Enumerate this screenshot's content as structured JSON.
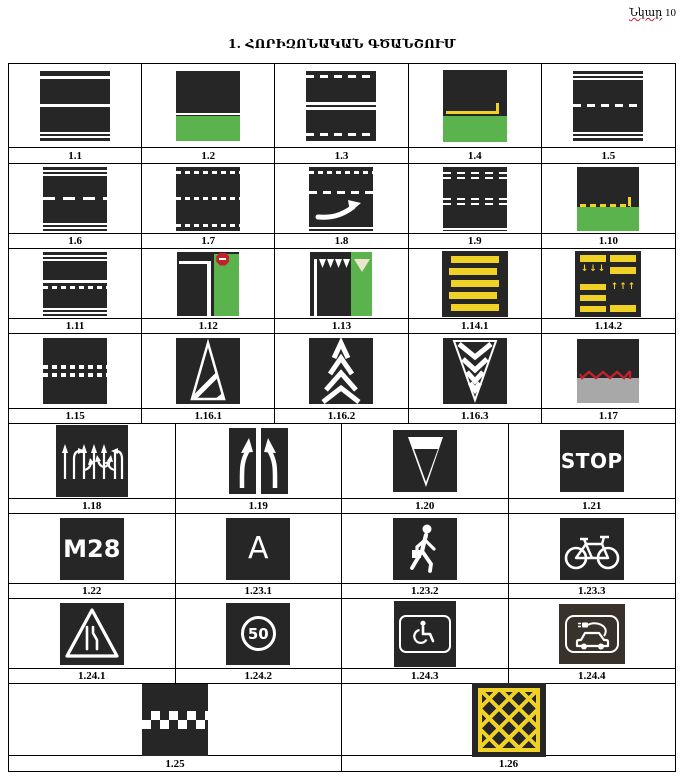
{
  "header": {
    "figure_word": "Նկար",
    "figure_number": "10",
    "title": "1. ՀՈՐԻԶՈՆԱԿԱՆ ԳԾԱՆՇՈՒՄ"
  },
  "labels": {
    "l1_1": "1.1",
    "l1_2": "1.2",
    "l1_3": "1.3",
    "l1_4": "1.4",
    "l1_5": "1.5",
    "l1_6": "1.6",
    "l1_7": "1.7",
    "l1_8": "1.8",
    "l1_9": "1.9",
    "l1_10": "1.10",
    "l1_11": "1.11",
    "l1_12": "1.12",
    "l1_13": "1.13",
    "l1_14_1": "1.14.1",
    "l1_14_2": "1.14.2",
    "l1_15": "1.15",
    "l1_16_1": "1.16.1",
    "l1_16_2": "1.16.2",
    "l1_16_3": "1.16.3",
    "l1_17": "1.17",
    "l1_18": "1.18",
    "l1_19": "1.19",
    "l1_20": "1.20",
    "l1_21": "1.21",
    "l1_22": "1.22",
    "l1_23_1": "1.23.1",
    "l1_23_2": "1.23.2",
    "l1_23_3": "1.23.3",
    "l1_24_1": "1.24.1",
    "l1_24_2": "1.24.2",
    "l1_24_3": "1.24.3",
    "l1_24_4": "1.24.4",
    "l1_25": "1.25",
    "l1_26": "1.26"
  },
  "sign_text": {
    "stop": "STOP",
    "route_number": "M28",
    "bus_lane": "A",
    "speed_limit": "50"
  },
  "glyphs": {
    "arrows_down": "↓↓↓",
    "arrows_up": "↑↑↑"
  },
  "colors": {
    "road": "#262626",
    "grass": "#5bb34e",
    "yellow": "#f0d226",
    "red": "#c4202a",
    "sidewalk": "#a8a8a8",
    "cream": "#ece4cc",
    "white": "#ffffff",
    "page": "#ffffff"
  }
}
